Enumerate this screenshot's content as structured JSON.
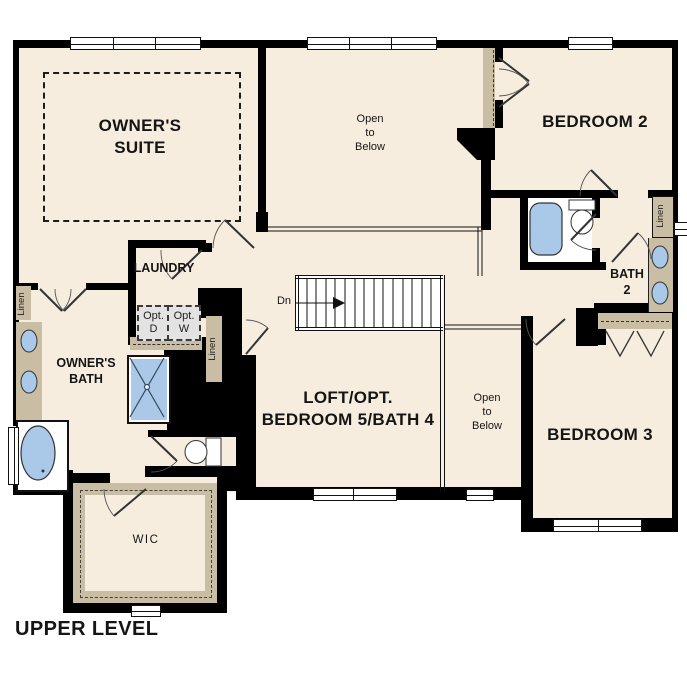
{
  "title": "UPPER LEVEL",
  "colors": {
    "floor": "#f7edde",
    "wall": "#000000",
    "fixture_blue": "#aac9e9",
    "counter_tan": "#c9bda4",
    "optional_gray": "#e3e3e3"
  },
  "rooms": {
    "owners_suite": "OWNER'S\nSUITE",
    "open_to_below": "Open\nto\nBelow",
    "bedroom_2": "BEDROOM 2",
    "laundry": "LAUNDRY",
    "owners_bath": "OWNER'S\nBATH",
    "bath_2": "BATH\n2",
    "loft": "LOFT/OPT.\nBEDROOM 5/BATH 4",
    "bedroom_3": "BEDROOM 3",
    "wic": "WIC"
  },
  "annotations": {
    "stair_direction": "Dn",
    "linen": "Linen",
    "optional_dryer": "Opt.\nD",
    "optional_washer": "Opt.\nW"
  }
}
